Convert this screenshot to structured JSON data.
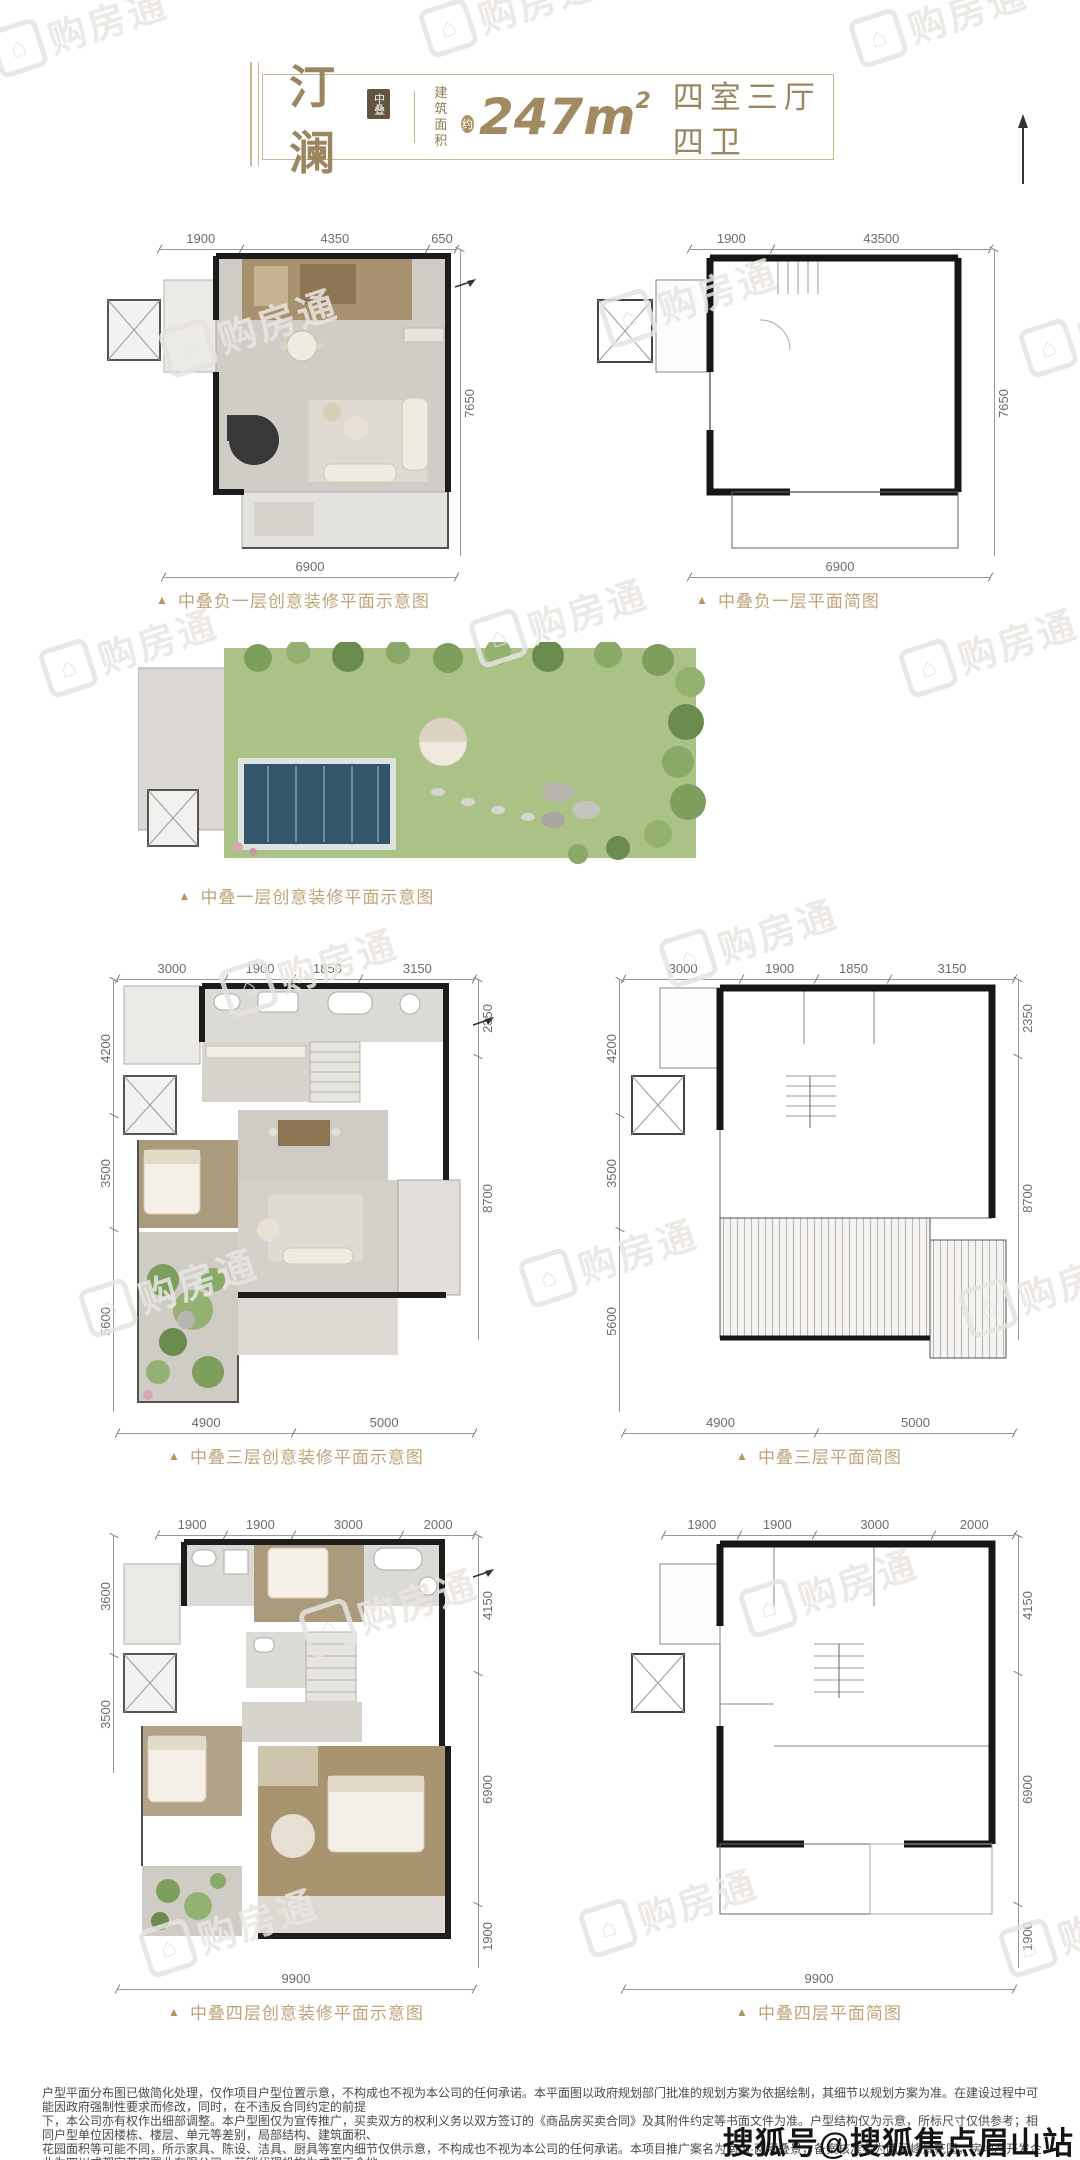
{
  "theme": {
    "accent": "#a18a5f",
    "caption_color": "#bfa379",
    "wall_color": "#1c1c1c"
  },
  "watermark": {
    "text": "购房通",
    "icon": "house-icon"
  },
  "header": {
    "title": "汀澜",
    "title_badge": "中叠",
    "area_label_line1": "建筑",
    "area_label_line2": "面积",
    "area_approx": "约",
    "area_value": "247m",
    "area_exponent": "2",
    "layout_text": "四室三厅四卫"
  },
  "plans": [
    {
      "caption": "中叠负一层创意装修平面示意图",
      "marker": "▲",
      "dims_top": [
        "1900",
        "4350",
        "650"
      ],
      "dims_right": [
        "7650"
      ],
      "dims_bottom": [
        "6900"
      ]
    },
    {
      "caption": "中叠负一层平面简图",
      "marker": "▲",
      "dims_top": [
        "1900",
        "43500"
      ],
      "dims_right": [
        "7650"
      ],
      "dims_bottom": [
        "6900"
      ]
    },
    {
      "caption": "中叠一层创意装修平面示意图",
      "marker": "▲"
    },
    {
      "caption": "中叠三层创意装修平面示意图",
      "marker": "▲",
      "dims_top": [
        "3000",
        "1900",
        "1850",
        "3150"
      ],
      "dims_left": [
        "4200",
        "3500",
        "5600"
      ],
      "dims_right": [
        "2350",
        "8700"
      ],
      "dims_bottom": [
        "4900",
        "5000"
      ]
    },
    {
      "caption": "中叠三层平面简图",
      "marker": "▲",
      "dims_top": [
        "3000",
        "1900",
        "1850",
        "3150"
      ],
      "dims_left": [
        "4200",
        "3500",
        "5600"
      ],
      "dims_right": [
        "2350",
        "8700"
      ],
      "dims_bottom": [
        "4900",
        "5000"
      ]
    },
    {
      "caption": "中叠四层创意装修平面示意图",
      "marker": "▲",
      "dims_top": [
        "1900",
        "1900",
        "3000",
        "2000"
      ],
      "dims_left": [
        "3600",
        "3500"
      ],
      "dims_right": [
        "4150",
        "6900",
        "1900"
      ],
      "dims_bottom": [
        "9900"
      ]
    },
    {
      "caption": "中叠四层平面简图",
      "marker": "▲",
      "dims_top": [
        "1900",
        "1900",
        "3000",
        "2000"
      ],
      "dims_right": [
        "4150",
        "6900",
        "1900"
      ],
      "dims_bottom": [
        "9900"
      ]
    }
  ],
  "footer": {
    "disclaimer_lines": [
      "户型平面分布图已做简化处理，仅作项目户型位置示意，不构成也不视为本公司的任何承诺。本平面图以政府规划部门批准的规划方案为依据绘制，其细节以规划方案为准。在建设过程中可能因政府强制性要求而修改，同时，在不违反合同约定的前提",
      "下，本公司亦有权作出细部调整。本户型图仅为宣传推广，买卖双方的权利义务以双方签订的《商品房买卖合同》及其附件约定等书面文件为准。户型结构仅为示意，所标尺寸仅供参考；相同户型单位因楼栋、楼层、单元等差别，局部结构、建筑面积、",
      "花园面积等可能不同，所示家具、陈设、洁具、厨具等室内细节仅供示意，不构成也不视为本公司的任何承诺。本项目推广案名为南山·两河叠景，备案核准名为两河峰景花园，房地产开发企业为四川成都宇荟宸置业有限公司，营销代理机构为成都正合地",
      "产顾问股份有限公司。本公司保留对此宣传资料修改的权利，资料制作时间为2022年11月1日，有效期为三个月，敬请留意最新资料。"
    ],
    "sohu_badge": "搜狐号@搜狐焦点眉山站"
  }
}
